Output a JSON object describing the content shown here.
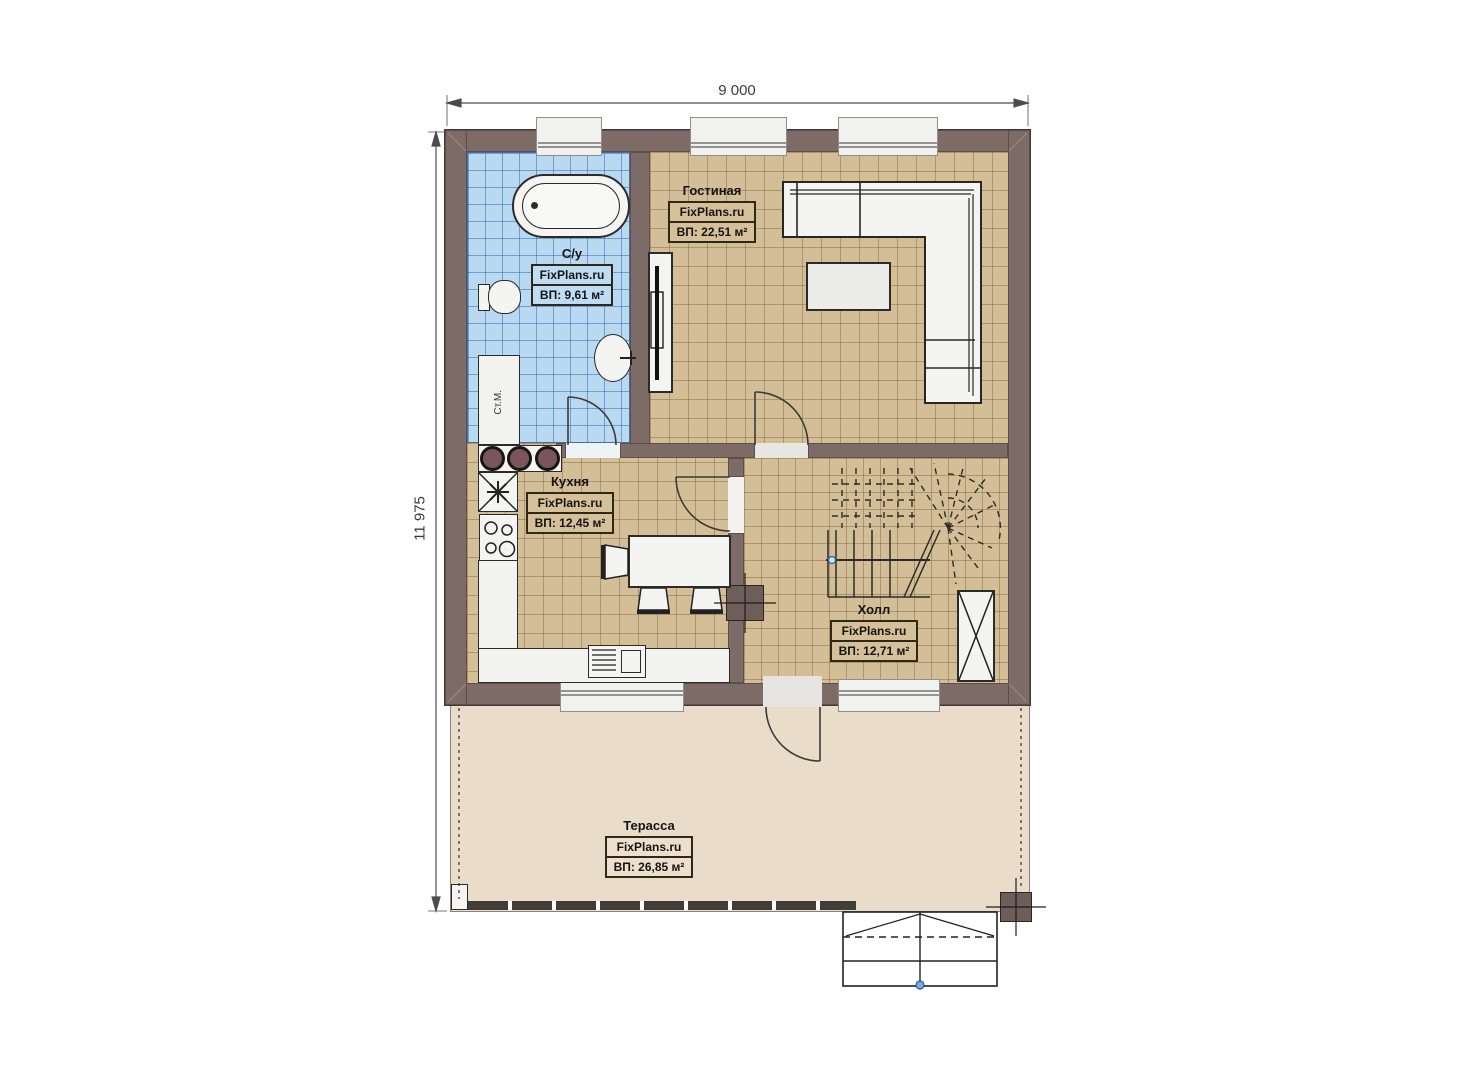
{
  "dimensions": {
    "width_label": "9 000",
    "height_label": "11 975"
  },
  "rooms": {
    "bathroom": {
      "name": "С/у",
      "brand": "FixPlans.ru",
      "area": "ВП: 9,61 м²"
    },
    "living": {
      "name": "Гостиная",
      "brand": "FixPlans.ru",
      "area": "ВП: 22,51 м²"
    },
    "kitchen": {
      "name": "Кухня",
      "brand": "FixPlans.ru",
      "area": "ВП: 12,45 м²"
    },
    "hall": {
      "name": "Холл",
      "brand": "FixPlans.ru",
      "area": "ВП: 12,71 м²"
    },
    "terrace": {
      "name": "Терасса",
      "brand": "FixPlans.ru",
      "area": "ВП: 26,85 м²"
    }
  },
  "appliances": {
    "washing_machine": "Ст.М."
  },
  "colors": {
    "wall": "#7c6b67",
    "bathroom_floor": "#b9d9f1",
    "room_floor": "#d4be98",
    "terrace_floor": "#e9ddc9",
    "furniture": "#f4f4f2",
    "stair_dot": "#7ea7d8"
  }
}
